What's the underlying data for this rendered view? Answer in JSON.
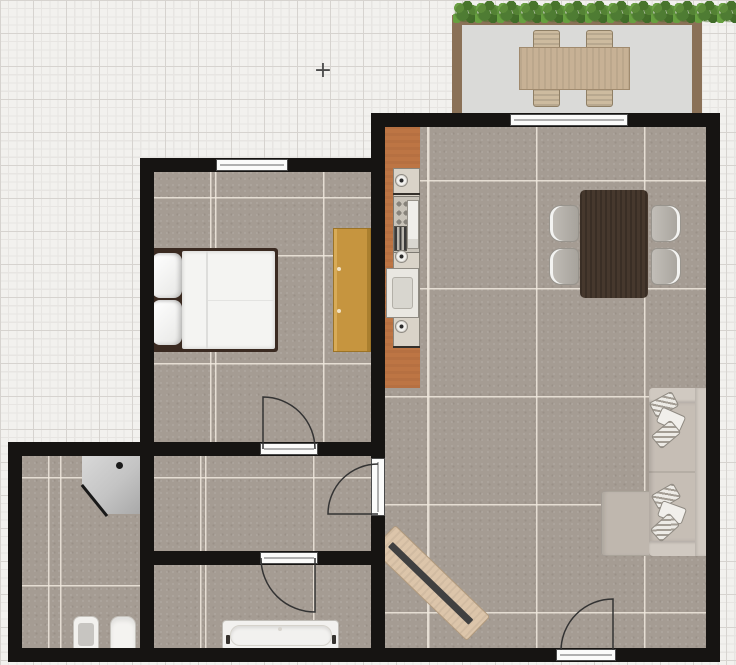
{
  "app": {
    "type": "floor-plan-editor-canvas",
    "view": "2d-top-down",
    "visible_text": "none"
  },
  "canvas": {
    "width_px": 736,
    "height_px": 665,
    "cursor_marker_symbol": "+"
  },
  "colors": {
    "background": "#f2f1ee",
    "grid_minor": "#e7e5e2",
    "grid_major": "#d6d3cf",
    "wall": "#161412",
    "floor_tile": "#a59c93",
    "floor_grout": "#ece4da",
    "balcony_floor": "#dadad8",
    "balcony_wall": "#8a7157",
    "hedge_green": "#54863a",
    "kitchen_counter": "#bd7544",
    "wardrobe": "#c6953f",
    "bed_frame": "#3a2a21",
    "dining_table": "#46382d",
    "sofa": "#c6beb5",
    "tv_board": "#dcc5aa",
    "fixture_white": "#f2f1ee",
    "window_frame": "#4a4a4a"
  },
  "rooms": [
    {
      "id": "bedroom"
    },
    {
      "id": "hallway"
    },
    {
      "id": "bathroom-1",
      "note": "corner shower, toilet, bidet"
    },
    {
      "id": "bathroom-2",
      "note": "bathtub"
    },
    {
      "id": "living-room-kitchen",
      "note": "kitchen counter strip along left wall"
    },
    {
      "id": "balcony",
      "note": "hedge planters along top edge"
    }
  ],
  "furniture": [
    {
      "name": "double-bed",
      "room": "bedroom"
    },
    {
      "name": "wardrobe",
      "room": "bedroom"
    },
    {
      "name": "kitchen-counter-with-sink-stove-oven",
      "room": "living-room-kitchen"
    },
    {
      "name": "dining-table",
      "room": "living-room-kitchen",
      "seats": 4
    },
    {
      "name": "dining-chair",
      "room": "living-room-kitchen",
      "count": 4
    },
    {
      "name": "corner-sofa-with-cushions",
      "room": "living-room-kitchen"
    },
    {
      "name": "tv-sideboard-rotated-45deg",
      "room": "living-room-kitchen"
    },
    {
      "name": "corner-shower",
      "room": "bathroom-1"
    },
    {
      "name": "toilet",
      "room": "bathroom-1"
    },
    {
      "name": "bidet",
      "room": "bathroom-1"
    },
    {
      "name": "bathtub",
      "room": "bathroom-2"
    },
    {
      "name": "patio-table",
      "room": "balcony",
      "seats": 4
    },
    {
      "name": "hedge-plant-row",
      "room": "balcony",
      "plant_count": 13
    }
  ],
  "openings": {
    "windows": [
      {
        "room": "bedroom",
        "wall": "top"
      },
      {
        "room": "living-room-kitchen",
        "wall": "top-to-balcony"
      }
    ],
    "doors": [
      {
        "from": "bedroom",
        "to": "hallway",
        "swing": "into-bedroom"
      },
      {
        "from": "living-room-kitchen",
        "to": "hallway",
        "swing": "into-hallway"
      },
      {
        "from": "hallway",
        "to": "bathroom-2",
        "swing": "into-bathroom"
      },
      {
        "name": "entrance",
        "room": "living-room-kitchen",
        "wall": "bottom",
        "swing": "into-living-room"
      }
    ]
  }
}
